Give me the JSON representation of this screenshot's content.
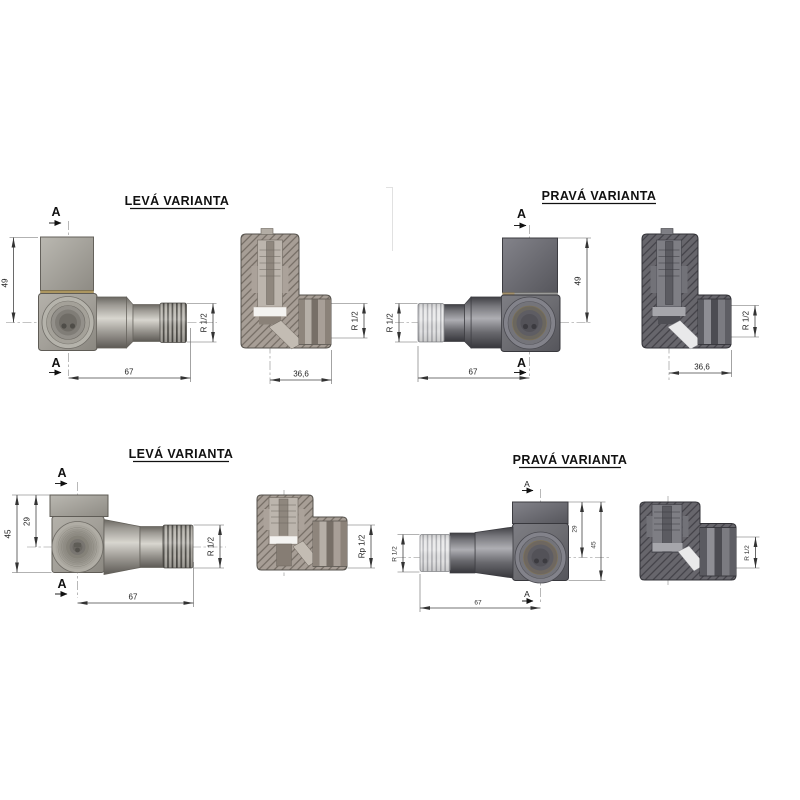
{
  "drawing": {
    "type": "technical-valve-drawing",
    "background": "#ffffff",
    "colors": {
      "light_metal": "#a7a49c",
      "dark_metal": "#6c6b70",
      "brass_seam": "#ac9660",
      "line": "#444444",
      "text": "#111111"
    }
  },
  "quadrants": {
    "top_left": {
      "title": "LEVÁ VARIANTA",
      "marker": "A",
      "dim_height": "49",
      "dim_length": "67",
      "dim_thread": "R 1/2",
      "section_width": "36,6",
      "section_thread": "R 1/2"
    },
    "top_right": {
      "title": "PRAVÁ VARIANTA",
      "marker": "A",
      "dim_height": "49",
      "dim_length": "67",
      "dim_thread": "R 1/2",
      "section_width": "36,6",
      "section_thread": "R 1/2"
    },
    "bottom_left": {
      "title": "LEVÁ VARIANTA",
      "marker": "A",
      "dim_height_total": "45",
      "dim_height_top": "29",
      "dim_length": "67",
      "dim_thread": "R 1/2",
      "section_thread": "Rp 1/2"
    },
    "bottom_right": {
      "title": "PRAVÁ VARIANTA",
      "marker": "A",
      "dim_height_total": "45",
      "dim_height_top": "29",
      "dim_length": "67",
      "dim_thread": "R 1/2",
      "section_thread": "R 1/2"
    }
  }
}
